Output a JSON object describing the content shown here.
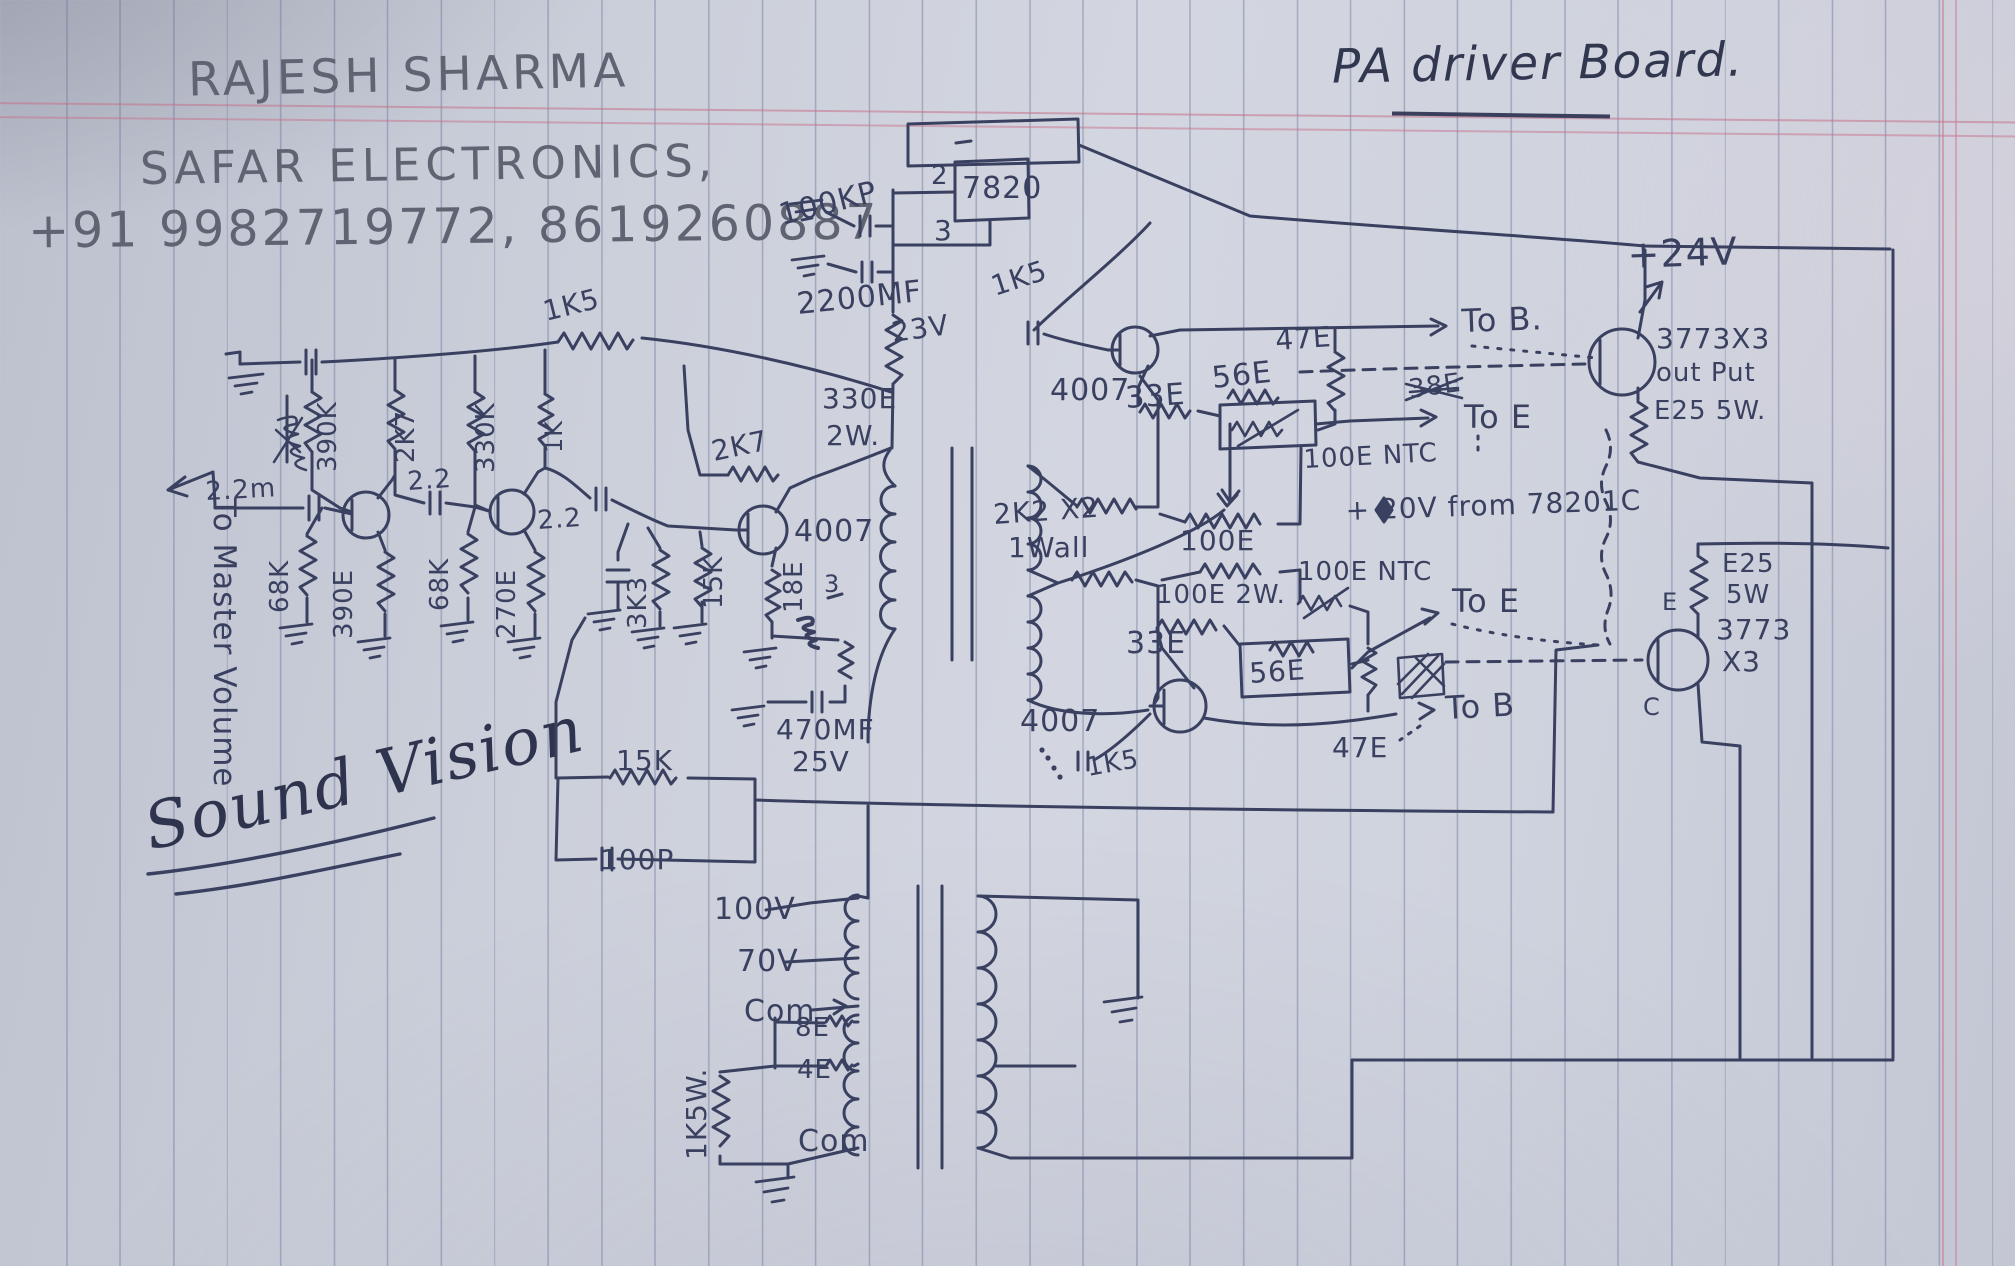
{
  "page": {
    "author": "RAJESH SHARMA",
    "company": "SAFAR ELECTRONICS,",
    "phone": "+91 9982719772, 8619260887",
    "title": "PA driver Board.",
    "signature": "Sound Vision"
  },
  "schematic": {
    "ink_color": "#394060",
    "pencil_color": "#5f6372",
    "labels": [
      {
        "id": "100kp",
        "t": "100KP",
        "x": 782,
        "y": 225,
        "r": -14,
        "s": 30
      },
      {
        "id": "2200mf",
        "t": "2200MF",
        "x": 798,
        "y": 314,
        "r": -6,
        "s": 30
      },
      {
        "id": "23v",
        "t": "23V",
        "x": 893,
        "y": 342,
        "r": -8,
        "s": 28
      },
      {
        "id": "pin2",
        "t": "2",
        "x": 931,
        "y": 184,
        "r": 0,
        "s": 26
      },
      {
        "id": "ic7820",
        "t": "7820",
        "x": 962,
        "y": 198,
        "r": 0,
        "s": 30
      },
      {
        "id": "pin3",
        "t": "3",
        "x": 934,
        "y": 240,
        "r": 0,
        "s": 28
      },
      {
        "id": "1k5-a",
        "t": "1K5",
        "x": 995,
        "y": 296,
        "r": -18,
        "s": 28
      },
      {
        "id": "4007-a",
        "t": "4007",
        "x": 1050,
        "y": 400,
        "r": 0,
        "s": 30
      },
      {
        "id": "33e-a",
        "t": "33E",
        "x": 1126,
        "y": 408,
        "r": -4,
        "s": 30
      },
      {
        "id": "56e-a",
        "t": "56E",
        "x": 1213,
        "y": 388,
        "r": -6,
        "s": 30
      },
      {
        "id": "47e-a",
        "t": "47E",
        "x": 1276,
        "y": 350,
        "r": -4,
        "s": 28
      },
      {
        "id": "tob-a",
        "t": "To B.",
        "x": 1462,
        "y": 332,
        "r": -2,
        "s": 32
      },
      {
        "id": "toe-a",
        "t": "To E",
        "x": 1464,
        "y": 428,
        "r": 0,
        "s": 32
      },
      {
        "id": "38e-crossed",
        "t": "38E",
        "x": 1410,
        "y": 398,
        "r": -8,
        "s": 26
      },
      {
        "id": "ntc-a",
        "t": "100E NTC",
        "x": 1304,
        "y": 468,
        "r": -3,
        "s": 26
      },
      {
        "id": "24v",
        "t": "+24V",
        "x": 1628,
        "y": 268,
        "r": -2,
        "s": 38
      },
      {
        "id": "3773-a",
        "t": "3773X3",
        "x": 1656,
        "y": 348,
        "r": 0,
        "s": 28
      },
      {
        "id": "output",
        "t": "out Put",
        "x": 1656,
        "y": 381,
        "r": 0,
        "s": 26
      },
      {
        "id": "e25-a",
        "t": "E25 5W.",
        "x": 1654,
        "y": 419,
        "r": 0,
        "s": 26
      },
      {
        "id": "20v-line",
        "t": "+ 20V from 78201C",
        "x": 1346,
        "y": 520,
        "r": -2,
        "s": 28
      },
      {
        "id": "330e",
        "t": "330E",
        "x": 822,
        "y": 408,
        "r": 0,
        "s": 28
      },
      {
        "id": "2w",
        "t": "2W.",
        "x": 826,
        "y": 445,
        "r": 0,
        "s": 28
      },
      {
        "id": "2k2x2",
        "t": "2K2 X2",
        "x": 994,
        "y": 524,
        "r": -4,
        "s": 28
      },
      {
        "id": "1wall",
        "t": "1Wall",
        "x": 1008,
        "y": 557,
        "r": 0,
        "s": 28
      },
      {
        "id": "100e-a",
        "t": "100E",
        "x": 1180,
        "y": 550,
        "r": 0,
        "s": 28
      },
      {
        "id": "100e-b",
        "t": "100E 2W.",
        "x": 1156,
        "y": 603,
        "r": 0,
        "s": 26
      },
      {
        "id": "ntc-b",
        "t": "100E NTC",
        "x": 1298,
        "y": 580,
        "r": 0,
        "s": 26
      },
      {
        "id": "33e-b",
        "t": "33E",
        "x": 1126,
        "y": 653,
        "r": 0,
        "s": 30
      },
      {
        "id": "56e-b",
        "t": "56E",
        "x": 1250,
        "y": 683,
        "r": -4,
        "s": 28
      },
      {
        "id": "4007-c",
        "t": "4007",
        "x": 1020,
        "y": 731,
        "r": 0,
        "s": 30
      },
      {
        "id": "47e-b",
        "t": "47E",
        "x": 1332,
        "y": 757,
        "r": 0,
        "s": 28
      },
      {
        "id": "toe-b",
        "t": "To E",
        "x": 1452,
        "y": 612,
        "r": 0,
        "s": 32
      },
      {
        "id": "tob-b",
        "t": "To B",
        "x": 1446,
        "y": 719,
        "r": -3,
        "s": 32
      },
      {
        "id": "1k5-c",
        "t": "1K5",
        "x": 1088,
        "y": 776,
        "r": -10,
        "s": 26
      },
      {
        "id": "e25-b1",
        "t": "E25",
        "x": 1722,
        "y": 572,
        "r": 0,
        "s": 26
      },
      {
        "id": "e25-b2",
        "t": "5W",
        "x": 1726,
        "y": 603,
        "r": 0,
        "s": 26
      },
      {
        "id": "3773-b1",
        "t": "3773",
        "x": 1716,
        "y": 639,
        "r": 0,
        "s": 28
      },
      {
        "id": "3773-b2",
        "t": "X3",
        "x": 1722,
        "y": 671,
        "r": 0,
        "s": 28
      },
      {
        "id": "pin-e",
        "t": "E",
        "x": 1662,
        "y": 610,
        "r": 0,
        "s": 24
      },
      {
        "id": "pin-c",
        "t": "C",
        "x": 1643,
        "y": 715,
        "r": 0,
        "s": 24
      },
      {
        "id": "1k5-b",
        "t": "1K5",
        "x": 546,
        "y": 321,
        "r": -14,
        "s": 28
      },
      {
        "id": "390k",
        "t": "390K",
        "x": 336,
        "y": 472,
        "r": -90,
        "s": 26
      },
      {
        "id": "2k7-a",
        "t": "2K7",
        "x": 414,
        "y": 463,
        "r": -90,
        "s": 26
      },
      {
        "id": "330k",
        "t": "330K",
        "x": 494,
        "y": 473,
        "r": -90,
        "s": 26
      },
      {
        "id": "1k",
        "t": "1K",
        "x": 562,
        "y": 453,
        "r": -90,
        "s": 24
      },
      {
        "id": "68k-a",
        "t": "68K",
        "x": 288,
        "y": 613,
        "r": -90,
        "s": 26
      },
      {
        "id": "390e",
        "t": "390E",
        "x": 352,
        "y": 639,
        "r": -90,
        "s": 26
      },
      {
        "id": "68k-b",
        "t": "68K",
        "x": 448,
        "y": 611,
        "r": -90,
        "s": 26
      },
      {
        "id": "270e",
        "t": "270E",
        "x": 515,
        "y": 639,
        "r": -90,
        "s": 26
      },
      {
        "id": "cap22-a",
        "t": "2.2",
        "x": 408,
        "y": 490,
        "r": -4,
        "s": 26
      },
      {
        "id": "cap22-b",
        "t": "2.2",
        "x": 538,
        "y": 529,
        "r": -4,
        "s": 26
      },
      {
        "id": "cap22-in",
        "t": "2.2m",
        "x": 206,
        "y": 500,
        "r": -3,
        "s": 26
      },
      {
        "id": "3k3",
        "t": "3K3",
        "x": 646,
        "y": 629,
        "r": -90,
        "s": 26
      },
      {
        "id": "15k-a",
        "t": "15K",
        "x": 722,
        "y": 609,
        "r": -90,
        "s": 26
      },
      {
        "id": "18e",
        "t": "18E",
        "x": 802,
        "y": 613,
        "r": -90,
        "s": 26
      },
      {
        "id": "num3",
        "t": "3",
        "x": 824,
        "y": 592,
        "r": 0,
        "s": 24
      },
      {
        "id": "2k7-b",
        "t": "2K7",
        "x": 714,
        "y": 461,
        "r": -12,
        "s": 28
      },
      {
        "id": "4007-b",
        "t": "4007",
        "x": 794,
        "y": 541,
        "r": 0,
        "s": 30
      },
      {
        "id": "470mf",
        "t": "470MF",
        "x": 776,
        "y": 739,
        "r": 0,
        "s": 28
      },
      {
        "id": "25v",
        "t": "25V",
        "x": 792,
        "y": 771,
        "r": 0,
        "s": 28
      },
      {
        "id": "15k-b",
        "t": "15K",
        "x": 616,
        "y": 770,
        "r": 0,
        "s": 28
      },
      {
        "id": "100p",
        "t": "100P",
        "x": 600,
        "y": 869,
        "r": 0,
        "s": 28
      },
      {
        "id": "master-volume",
        "t": "To Master Volume",
        "x": 214,
        "y": 498,
        "r": 90,
        "s": 31
      },
      {
        "id": "100v",
        "t": "100V",
        "x": 714,
        "y": 919,
        "r": 0,
        "s": 30
      },
      {
        "id": "70v",
        "t": "70V",
        "x": 737,
        "y": 971,
        "r": 0,
        "s": 30
      },
      {
        "id": "com-a",
        "t": "Com",
        "x": 744,
        "y": 1021,
        "r": 0,
        "s": 30
      },
      {
        "id": "8e",
        "t": "8E",
        "x": 795,
        "y": 1036,
        "r": 0,
        "s": 26
      },
      {
        "id": "4e",
        "t": "4E",
        "x": 797,
        "y": 1078,
        "r": 0,
        "s": 26
      },
      {
        "id": "com-b",
        "t": "Com",
        "x": 798,
        "y": 1151,
        "r": 0,
        "s": 30
      },
      {
        "id": "1k5w",
        "t": "1K5W.",
        "x": 706,
        "y": 1160,
        "r": -90,
        "s": 28
      }
    ]
  }
}
